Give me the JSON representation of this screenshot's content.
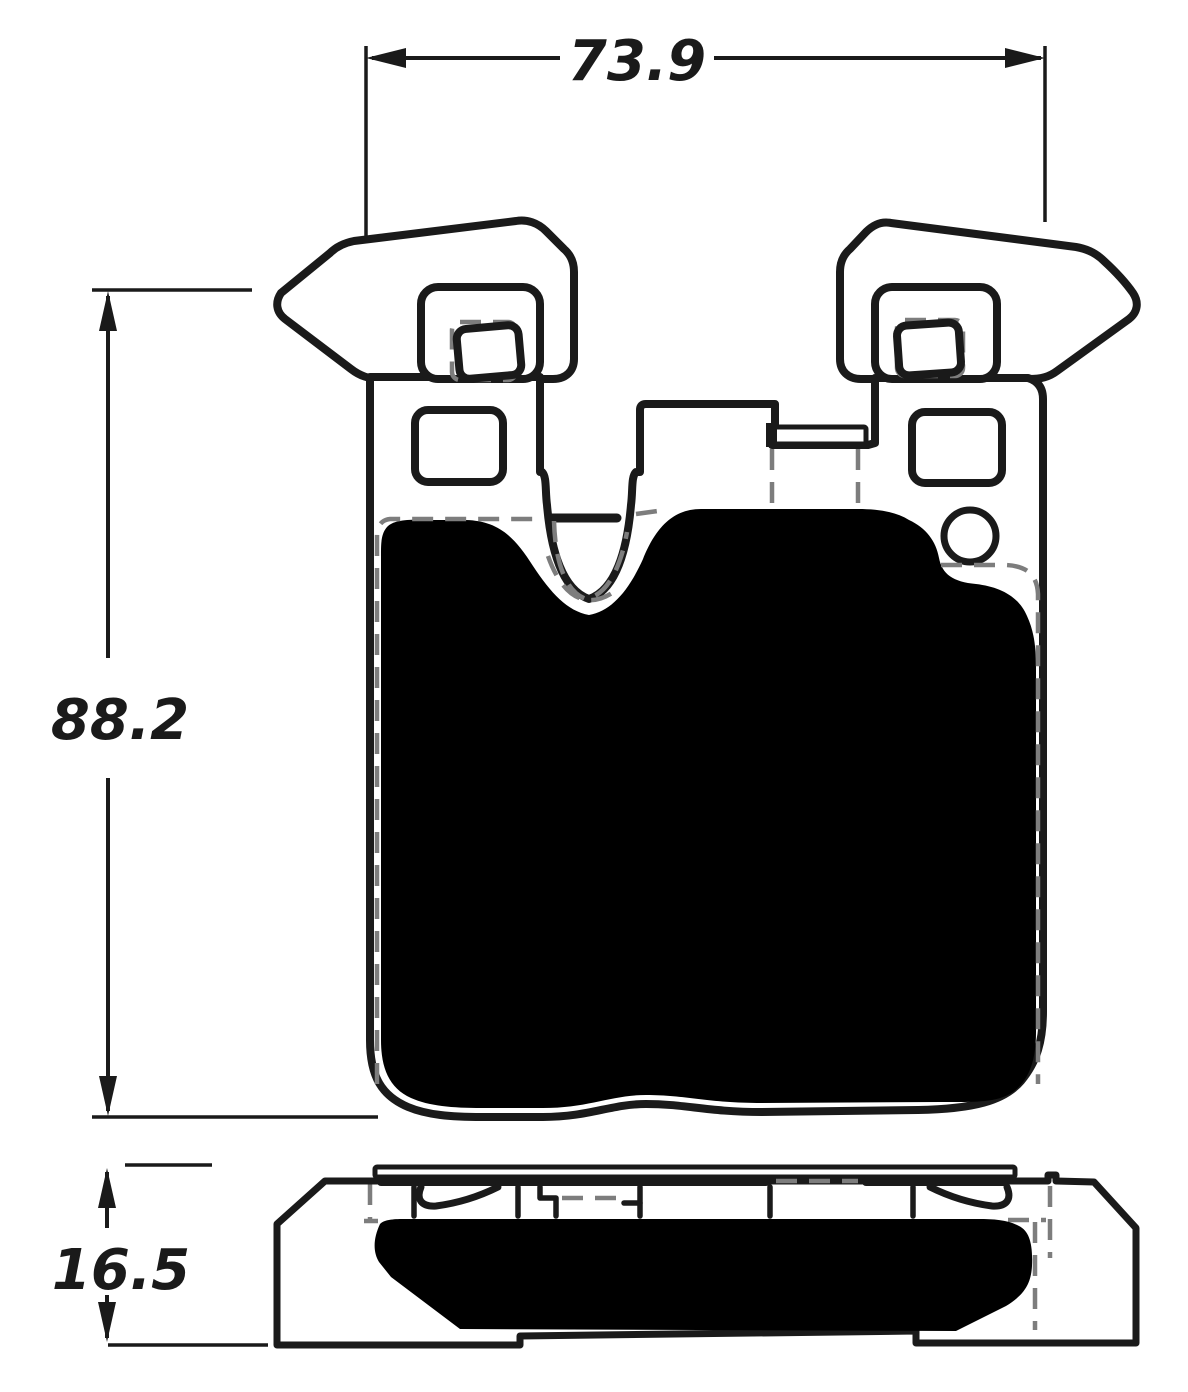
{
  "dimensions": {
    "width_mm": "73.9",
    "height_mm": "88.2",
    "thickness_mm": "16.5"
  },
  "colors": {
    "line": "#1a1a1a",
    "hidden_line": "#7d7d7d",
    "friction_material": "#000000",
    "background": "#ffffff"
  }
}
